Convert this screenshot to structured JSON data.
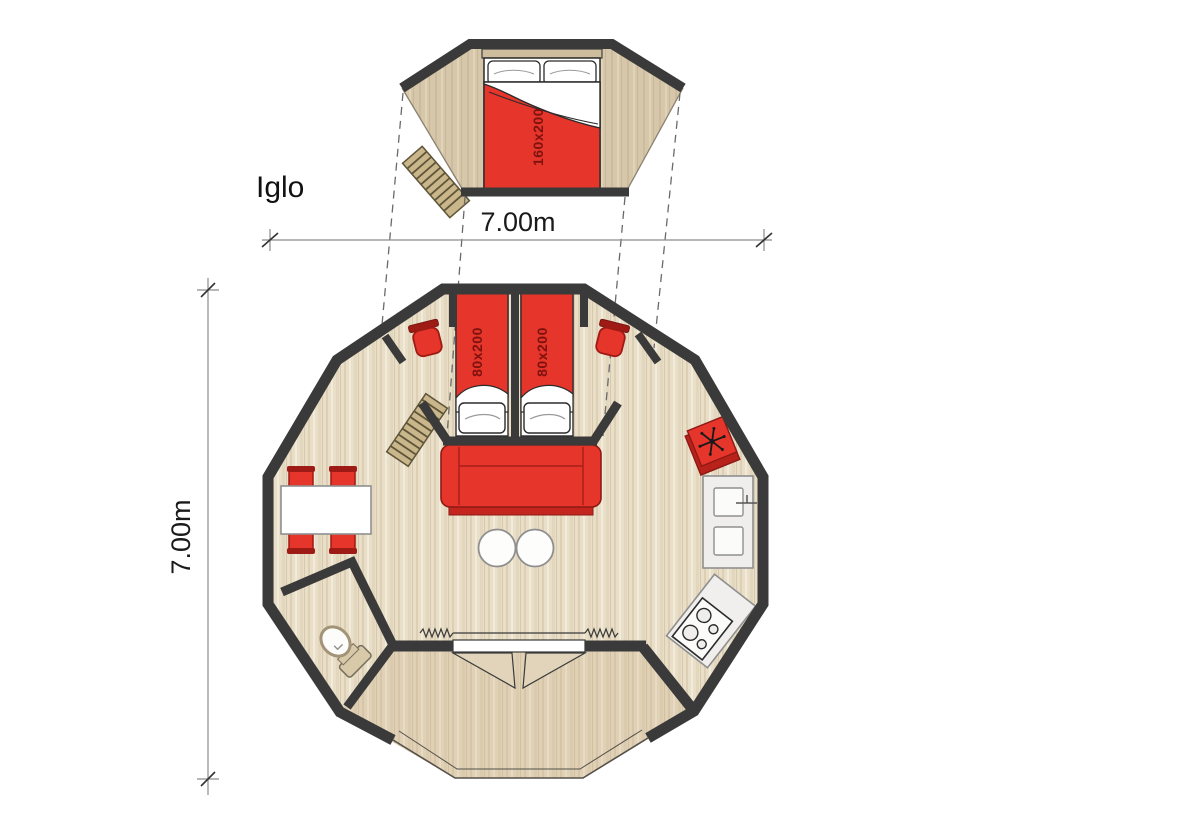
{
  "title": "Iglo",
  "labels": {
    "plan_name": "Iglo",
    "width_dimension": "7.00m",
    "height_dimension": "7.00m",
    "loft_bed_size": "160x200",
    "bed_left_size": "80x200",
    "bed_right_size": "80x200"
  },
  "colors": {
    "wall": "#3a3a3a",
    "floor_main": "#e9dec8",
    "floor_loft": "#d6c7aa",
    "accent_red": "#e6352b",
    "accent_dark_red": "#9e1b15",
    "counter_gray": "#efeeec",
    "ladder_wood": "#c9b68b",
    "dimension_line": "#8c8c8c"
  }
}
